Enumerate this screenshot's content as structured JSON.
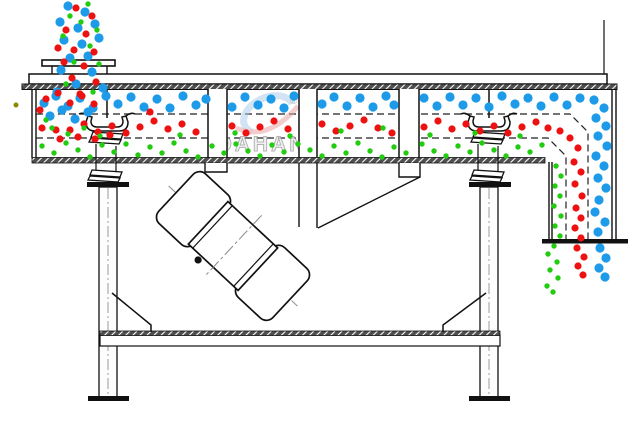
{
  "diagram": {
    "title": "Linear vibrating screen working-principle cross-section",
    "watermark": {
      "brand": "DAHAN",
      "registered": "®"
    },
    "colors": {
      "line": "#1a1a1a",
      "hatch": "#4f4f4f",
      "coarse": "#1e9be8",
      "medium": "#ee1111",
      "fine": "#22cc11",
      "stray": "#8a8a00"
    },
    "particles": {
      "coarse_blue": {
        "color": "#1e9be8",
        "radius": 4.6,
        "points": [
          [
            68,
            6
          ],
          [
            85,
            12
          ],
          [
            60,
            22
          ],
          [
            78,
            28
          ],
          [
            95,
            24
          ],
          [
            64,
            40
          ],
          [
            82,
            44
          ],
          [
            99,
            38
          ],
          [
            70,
            58
          ],
          [
            88,
            56
          ],
          [
            61,
            70
          ],
          [
            92,
            72
          ],
          [
            76,
            84
          ],
          [
            103,
            88
          ],
          [
            57,
            92
          ],
          [
            44,
            103
          ],
          [
            56,
            96
          ],
          [
            68,
            106
          ],
          [
            80,
            98
          ],
          [
            93,
            108
          ],
          [
            106,
            96
          ],
          [
            118,
            104
          ],
          [
            131,
            97
          ],
          [
            144,
            107
          ],
          [
            157,
            99
          ],
          [
            170,
            108
          ],
          [
            183,
            96
          ],
          [
            196,
            105
          ],
          [
            206,
            99
          ],
          [
            232,
            107
          ],
          [
            245,
            97
          ],
          [
            258,
            105
          ],
          [
            271,
            99
          ],
          [
            284,
            108
          ],
          [
            294,
            96
          ],
          [
            322,
            104
          ],
          [
            334,
            97
          ],
          [
            347,
            106
          ],
          [
            360,
            98
          ],
          [
            373,
            107
          ],
          [
            386,
            96
          ],
          [
            394,
            105
          ],
          [
            424,
            98
          ],
          [
            437,
            106
          ],
          [
            450,
            97
          ],
          [
            463,
            105
          ],
          [
            476,
            98
          ],
          [
            489,
            107
          ],
          [
            502,
            96
          ],
          [
            515,
            104
          ],
          [
            528,
            98
          ],
          [
            541,
            106
          ],
          [
            554,
            97
          ],
          [
            567,
            105
          ],
          [
            580,
            98
          ],
          [
            50,
            116
          ],
          [
            62,
            110
          ],
          [
            75,
            119
          ],
          [
            88,
            112
          ],
          [
            594,
            100
          ],
          [
            604,
            108
          ],
          [
            596,
            118
          ],
          [
            606,
            126
          ],
          [
            598,
            136
          ],
          [
            607,
            146
          ],
          [
            596,
            156
          ],
          [
            604,
            166
          ],
          [
            598,
            178
          ],
          [
            606,
            188
          ],
          [
            599,
            200
          ],
          [
            595,
            212
          ],
          [
            605,
            222
          ],
          [
            598,
            232
          ],
          [
            600,
            248
          ],
          [
            606,
            258
          ],
          [
            599,
            268
          ],
          [
            605,
            277
          ]
        ]
      },
      "medium_red": {
        "color": "#ee1111",
        "radius": 3.6,
        "points": [
          [
            76,
            8
          ],
          [
            92,
            16
          ],
          [
            66,
            30
          ],
          [
            86,
            34
          ],
          [
            74,
            50
          ],
          [
            94,
            52
          ],
          [
            64,
            62
          ],
          [
            84,
            66
          ],
          [
            72,
            78
          ],
          [
            96,
            82
          ],
          [
            80,
            94
          ],
          [
            58,
            48
          ],
          [
            46,
            99
          ],
          [
            58,
            93
          ],
          [
            70,
            103
          ],
          [
            82,
            96
          ],
          [
            94,
            104
          ],
          [
            150,
            112
          ],
          [
            60,
            139
          ],
          [
            78,
            137
          ],
          [
            95,
            139
          ],
          [
            40,
            110
          ],
          [
            56,
            130
          ],
          [
            110,
            135
          ],
          [
            42,
            128
          ],
          [
            70,
            130
          ],
          [
            84,
            124
          ],
          [
            98,
            132
          ],
          [
            112,
            126
          ],
          [
            126,
            133
          ],
          [
            140,
            127
          ],
          [
            154,
            121
          ],
          [
            168,
            129
          ],
          [
            182,
            124
          ],
          [
            196,
            132
          ],
          [
            232,
            126
          ],
          [
            246,
            133
          ],
          [
            260,
            127
          ],
          [
            274,
            121
          ],
          [
            288,
            129
          ],
          [
            322,
            124
          ],
          [
            336,
            131
          ],
          [
            350,
            126
          ],
          [
            364,
            120
          ],
          [
            378,
            128
          ],
          [
            392,
            133
          ],
          [
            424,
            127
          ],
          [
            438,
            121
          ],
          [
            452,
            129
          ],
          [
            466,
            124
          ],
          [
            480,
            131
          ],
          [
            494,
            126
          ],
          [
            508,
            133
          ],
          [
            522,
            127
          ],
          [
            536,
            122
          ],
          [
            548,
            128
          ],
          [
            560,
            131
          ],
          [
            570,
            138
          ],
          [
            578,
            148
          ],
          [
            574,
            162
          ],
          [
            581,
            172
          ],
          [
            575,
            184
          ],
          [
            582,
            196
          ],
          [
            576,
            208
          ],
          [
            581,
            218
          ],
          [
            575,
            228
          ],
          [
            581,
            238
          ],
          [
            577,
            248
          ],
          [
            584,
            257
          ],
          [
            578,
            266
          ],
          [
            583,
            275
          ]
        ]
      },
      "fine_green": {
        "color": "#22cc11",
        "radius": 2.7,
        "points": [
          [
            88,
            4
          ],
          [
            70,
            16
          ],
          [
            97,
            30
          ],
          [
            63,
            36
          ],
          [
            90,
            46
          ],
          [
            74,
            62
          ],
          [
            99,
            64
          ],
          [
            66,
            84
          ],
          [
            93,
            92
          ],
          [
            81,
            22
          ],
          [
            52,
            128
          ],
          [
            68,
            134
          ],
          [
            84,
            128
          ],
          [
            100,
            136
          ],
          [
            46,
            120
          ],
          [
            180,
            135
          ],
          [
            235,
            133
          ],
          [
            290,
            136
          ],
          [
            341,
            131
          ],
          [
            383,
            128
          ],
          [
            430,
            135
          ],
          [
            475,
            133
          ],
          [
            520,
            136
          ],
          [
            42,
            146
          ],
          [
            54,
            153
          ],
          [
            66,
            143
          ],
          [
            78,
            150
          ],
          [
            90,
            157
          ],
          [
            102,
            145
          ],
          [
            114,
            152
          ],
          [
            126,
            144
          ],
          [
            138,
            155
          ],
          [
            150,
            147
          ],
          [
            162,
            153
          ],
          [
            174,
            143
          ],
          [
            186,
            151
          ],
          [
            198,
            157
          ],
          [
            212,
            146
          ],
          [
            224,
            153
          ],
          [
            236,
            144
          ],
          [
            248,
            151
          ],
          [
            260,
            156
          ],
          [
            272,
            145
          ],
          [
            284,
            152
          ],
          [
            298,
            144
          ],
          [
            310,
            150
          ],
          [
            322,
            156
          ],
          [
            334,
            146
          ],
          [
            346,
            153
          ],
          [
            358,
            143
          ],
          [
            370,
            151
          ],
          [
            382,
            157
          ],
          [
            394,
            147
          ],
          [
            406,
            153
          ],
          [
            422,
            144
          ],
          [
            434,
            151
          ],
          [
            446,
            156
          ],
          [
            458,
            146
          ],
          [
            470,
            152
          ],
          [
            482,
            143
          ],
          [
            494,
            150
          ],
          [
            506,
            156
          ],
          [
            518,
            147
          ],
          [
            530,
            152
          ],
          [
            542,
            145
          ],
          [
            556,
            166
          ],
          [
            561,
            176
          ],
          [
            555,
            186
          ],
          [
            560,
            196
          ],
          [
            554,
            206
          ],
          [
            561,
            216
          ],
          [
            555,
            226
          ],
          [
            560,
            236
          ],
          [
            554,
            246
          ],
          [
            548,
            254
          ],
          [
            557,
            262
          ],
          [
            550,
            270
          ],
          [
            558,
            278
          ],
          [
            547,
            286
          ],
          [
            553,
            292
          ]
        ]
      },
      "stray_olive": {
        "color": "#8a8a00",
        "radius": 2.5,
        "points": [
          [
            16,
            105
          ]
        ]
      }
    }
  }
}
